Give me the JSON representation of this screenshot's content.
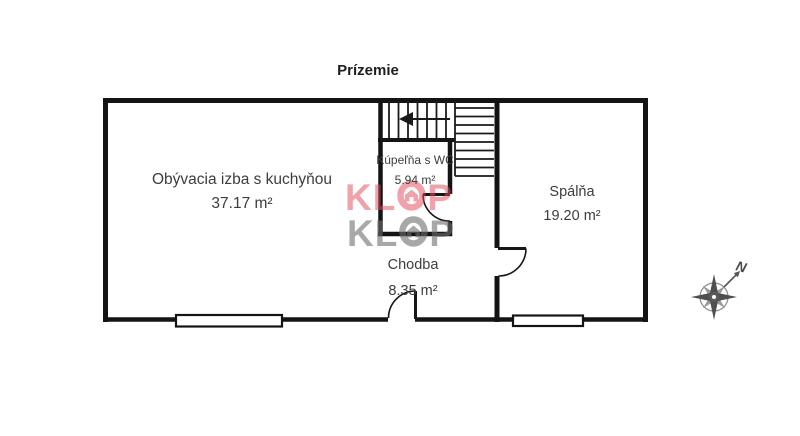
{
  "title": "Prízemie",
  "rooms": [
    {
      "name": "Obývacia izba s kuchyňou",
      "area": "37.17 m²"
    },
    {
      "name": "Kúpeľňa s WC",
      "area": "5.94 m²"
    },
    {
      "name": "Spálňa",
      "area": "19.20 m²"
    },
    {
      "name": "Chodba",
      "area": "8.35 m²"
    }
  ],
  "watermark": {
    "full": "KLOP",
    "kl": "KL",
    "p": "P"
  },
  "compass": {
    "north_label": "N"
  },
  "colors": {
    "wall": "#141414",
    "watermark_red": "#e24d5e",
    "watermark_gray": "#8f8f8f",
    "compass": "#5a5a5a"
  }
}
